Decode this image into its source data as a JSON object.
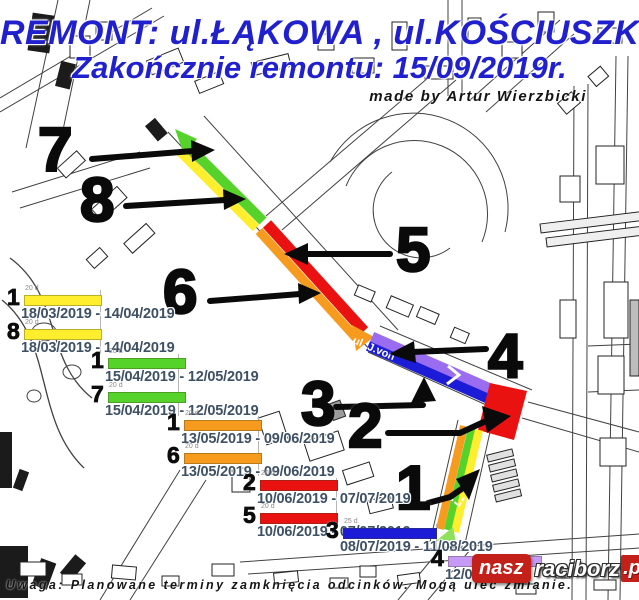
{
  "title": {
    "line1": "REMONT: ul.ŁĄKOWA , ul.KOŚCIUSZKI",
    "line2": "Zakończnie remontu: 15/09/2019r.",
    "credit": "made by Artur Wierzbicki"
  },
  "map": {
    "street_label": "ul. J.von",
    "segment_numbers": [
      "7",
      "8",
      "6",
      "5",
      "4",
      "3",
      "2",
      "1"
    ]
  },
  "legend": {
    "items": [
      {
        "num": "1",
        "duration": "20 d",
        "date_range": "18/03/2019 - 14/04/2019",
        "color_name": "yellow",
        "color": "#ffee2e"
      },
      {
        "num": "8",
        "duration": "20 d",
        "date_range": "18/03/2019 - 14/04/2019",
        "color_name": "yellow",
        "color": "#ffee2e"
      },
      {
        "num": "1",
        "duration": "20 d",
        "date_range": "15/04/2019 - 12/05/2019",
        "color_name": "green",
        "color": "#56d32a"
      },
      {
        "num": "7",
        "duration": "20 d",
        "date_range": "15/04/2019 - 12/05/2019",
        "color_name": "green",
        "color": "#56d32a"
      },
      {
        "num": "1",
        "duration": "20 d",
        "date_range": "13/05/2019 - 09/06/2019",
        "color_name": "orange",
        "color": "#f79b1e"
      },
      {
        "num": "6",
        "duration": "20 d",
        "date_range": "13/05/2019 - 09/06/2019",
        "color_name": "orange",
        "color": "#f79b1e"
      },
      {
        "num": "2",
        "duration": "20 d",
        "date_range": "10/06/2019 - 07/07/2019",
        "color_name": "red",
        "color": "#ea1111"
      },
      {
        "num": "5",
        "duration": "20 d",
        "date_range": "10/06/2019 - 07/07/2019",
        "color_name": "red",
        "color": "#ea1111"
      },
      {
        "num": "3",
        "duration": "25 d",
        "date_range": "08/07/2019 - 11/08/2019",
        "color_name": "blue",
        "color": "#1c1cd6"
      },
      {
        "num": "4",
        "duration": "25 d",
        "date_range": "12/08/",
        "color_name": "purple",
        "color": "#c89af7"
      }
    ]
  },
  "footer": {
    "warning": "Uwaga: Planowane terminy zamknięcia odcinków. Mogą ulec zmianie."
  },
  "logo": {
    "part1": "nasz",
    "part2": "raciborz",
    "part3": ".pl"
  },
  "colors": {
    "title_blue": "#2020cf",
    "date_text": "#3e5063",
    "annotation_black": "#0a0a0a",
    "logo_red": "#c32019"
  }
}
